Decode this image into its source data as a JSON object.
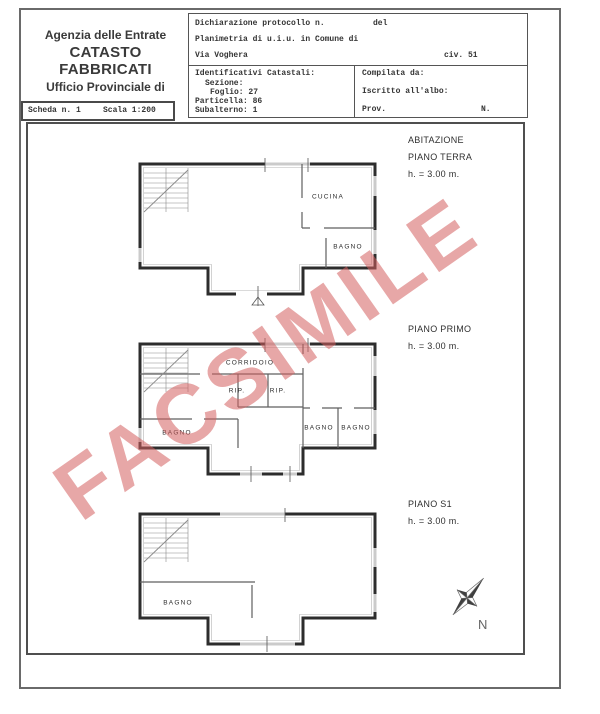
{
  "header": {
    "agency1": "Agenzia delle Entrate",
    "agency2": "CATASTO FABBRICATI",
    "agency3": "Ufficio Provinciale di",
    "scheda": "Scheda n. 1",
    "scala": "Scala 1:200"
  },
  "form": {
    "protocollo": "Dichiarazione protocollo n.",
    "del": "del",
    "planimetria": "Planimetria di u.i.u. in Comune di",
    "via": "Via Voghera",
    "civ": "civ. 51",
    "ident_title": "Identificativi Catastali:",
    "sezione": "Sezione:",
    "foglio": "Foglio: 27",
    "particella": "Particella: 86",
    "subalterno": "Subalterno: 1",
    "compilata": "Compilata da:",
    "iscritto": "Iscritto all'albo:",
    "prov": "Prov.",
    "n": "N."
  },
  "floor_labels": [
    {
      "a": "ABITAZIONE",
      "b": "PIANO TERRA",
      "h": "h. = 3.00 m."
    },
    {
      "a": "PIANO PRIMO",
      "h": "h. = 3.00 m."
    },
    {
      "a": "PIANO S1",
      "h": "h. = 3.00 m."
    }
  ],
  "rooms": {
    "terra_cucina": "CUCINA",
    "terra_bagno": "BAGNO",
    "primo_corridoio": "CORRIDOIO",
    "primo_rip1": "RIP.",
    "primo_rip2": "RIP.",
    "primo_bagno_left": "BAGNO",
    "primo_bagno_r1": "BAGNO",
    "primo_bagno_r2": "BAGNO",
    "s1_bagno": "BAGNO"
  },
  "watermark": {
    "text": "FACSIMILE",
    "color": "#d45f5f"
  },
  "compass": {
    "label": "N"
  },
  "colors": {
    "wall": "#2d2d2d",
    "window": "#cbcbcb",
    "border": "#555555"
  }
}
